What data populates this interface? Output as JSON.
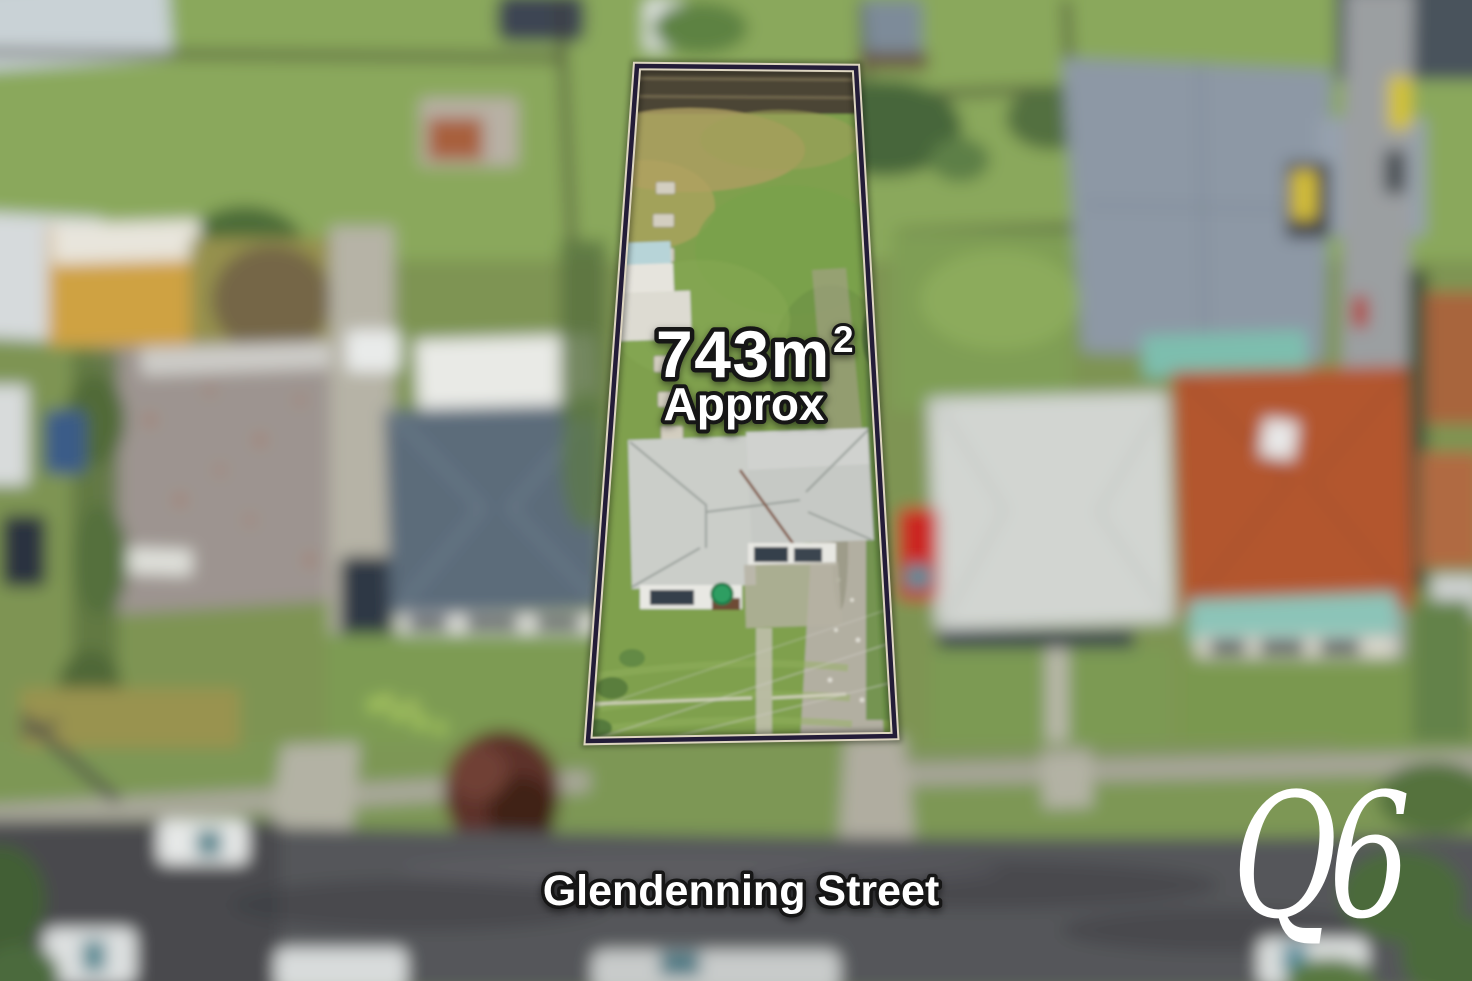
{
  "overlay": {
    "area_value": "743m",
    "area_exponent": "2",
    "area_qualifier": "Approx",
    "street_name": "Glendenning Street",
    "text_color": "#ffffff",
    "text_outline_color": "#141414"
  },
  "logo": {
    "text": "Q6",
    "color": "#ffffff"
  },
  "boundary": {
    "outline_dark": "#231c38",
    "outline_light": "#ddd5c0"
  },
  "palette": {
    "grass": "#7e9452",
    "road": "#55565a",
    "focal_lot_grass": "#7fa04e",
    "focal_roof": "#c9ccc8",
    "neighbor_roof_left": "#5c6c7a",
    "terracotta_roof": "#b3572e",
    "teal_verandah": "#8cc4b8",
    "red_car": "#cb2524",
    "driveway_concrete": "#b2afa1"
  }
}
